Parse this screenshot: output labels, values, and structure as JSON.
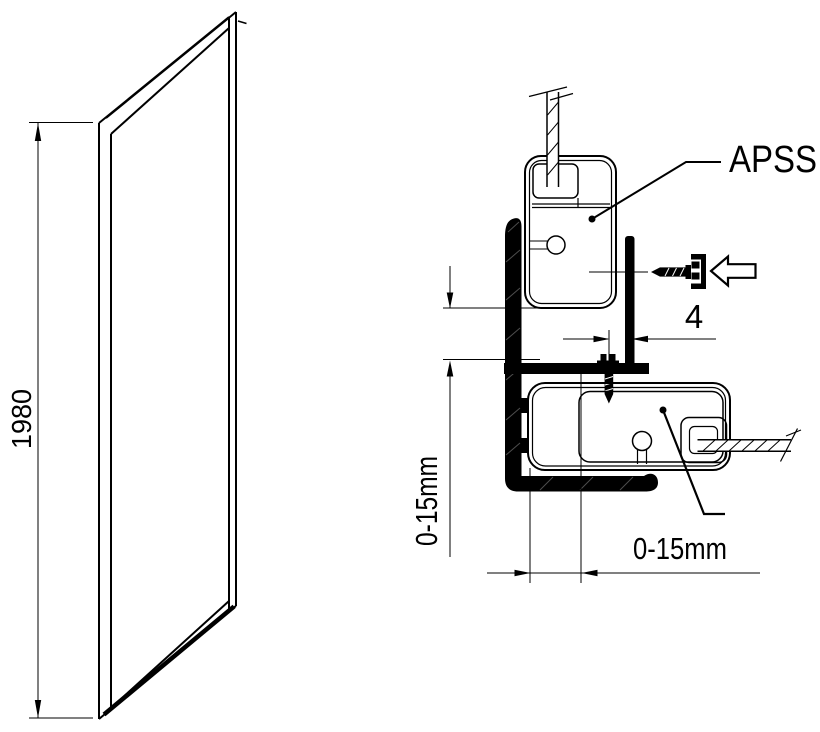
{
  "diagram": {
    "type": "shower-side-panel-installation-diagram",
    "panel_view": {
      "height_label": "1980"
    },
    "detail_view": {
      "profile_label": "APSS",
      "screw_offset_label": "4",
      "vertical_adjustment_label": "0-15mm",
      "horizontal_adjustment_label": "0-15mm"
    },
    "colors": {
      "line": "#000000",
      "background": "#ffffff"
    }
  }
}
